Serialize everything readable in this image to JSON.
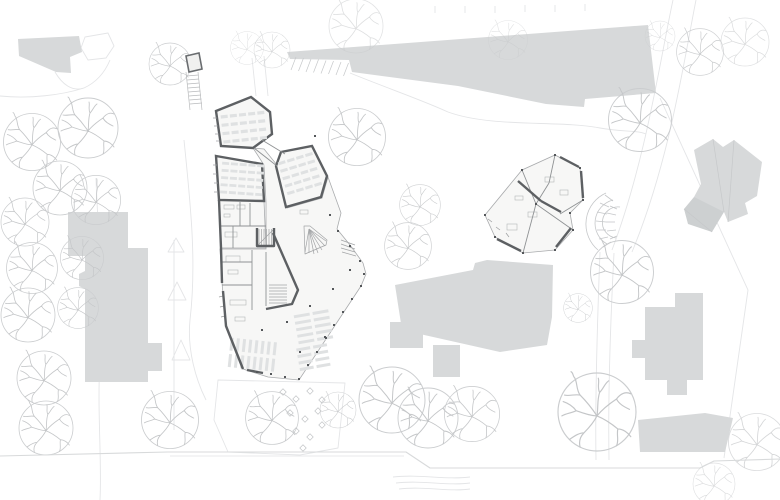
{
  "meta": {
    "kind": "architectural-site-plan",
    "width": 780,
    "height": 500,
    "background": "#ffffff"
  },
  "palette": {
    "context_fill": "#d7d9da",
    "context_fill_dark": "#cdd0d1",
    "wall_dark": "#5d6063",
    "footprint_fill": "#f7f7f6",
    "footprint_stroke": "#a9abad",
    "interior_line": "#8f9294",
    "stair_line": "#a2a4a6",
    "tick_line": "#9b9d9f",
    "furniture_fill": "#dfe1e2",
    "fixture_stroke": "#b4b6b8",
    "dot_fill": "#54575a",
    "tree_circle": "#cbcdcf",
    "tree_branch": "#c4c6c8",
    "faint_line": "#e4e5e7",
    "detail_line": "#c6c8ca",
    "boundary_line": "#d8dadb",
    "amphi_line": "#c5c7c9",
    "diamond_stroke": "#c3c5c7",
    "shelter_stroke": "#6a6d70",
    "ladder_line": "#b9bbbd"
  },
  "tree_symbol": {
    "circle_r": 30,
    "branches": "M0,3 C-4,-3 -8,-8 -13,-13 M-13,-13 C-16,-17 -15,-22 -17,-26 M-13,-13 C-17,-14 -21,-12 -25,-13 M-17,-26 C-19,-28 -18,-30 -20,-31 M0,3 C4,-2 9,-6 15,-10 M15,-10 C18,-14 22,-16 26,-14 M15,-10 C17,-6 21,-4 25,-2 M0,3 C5,5 10,8 16,13 M16,13 C20,13 24,16 26,19 M16,13 C15,18 17,22 15,26 M0,3 C-2,7 -5,11 -10,16 M-10,16 C-13,19 -14,23 -13,27 M-10,16 C-14,16 -18,19 -21,21 M0,3 C-5,3 -10,1 -16,-1 M-16,-1 C-20,1 -24,1 -27,3 M-16,-1 C-19,-5 -23,-7 -26,-8 M0,3 C1,-3 0,-9 2,-15 M2,-15 C0,-19 2,-23 1,-26 M2,-15 C5,-18 6,-22 9,-24"
  },
  "layers": [
    {
      "name": "faint-site-lines",
      "type": "paths",
      "stroke": "#e4e5e7",
      "width": 0.9,
      "items": [
        "M0,96 C30,99 62,95 84,88 C97,82 105,72 110,60",
        "M55,72 C62,84 72,92 84,88",
        "M85,37 L108,33 L114,46 L106,58 L88,60 L81,48 Z",
        "M96,178 C98,240 105,300 100,360 C97,410 102,460 100,500",
        "M184,140 C190,200 197,260 190,320 C187,350 196,380 206,400",
        "M252,58 L256,96",
        "M264,56 L268,96",
        "M350,73 C392,90 422,100 448,112",
        "M448,112 C492,128 560,120 600,128 C622,132 636,130 646,134",
        "M673,0 C660,60 646,160 612,250",
        "M696,0 C684,60 670,160 632,252",
        "M600,252 C597,330 595,400 596,460",
        "M614,253 C610,330 608,400 609,460",
        "M660,98 L748,290 L724,458",
        "M174,240 L174,430",
        "M168,252 L184,252 L176,238 Z",
        "M168,300 L186,300 L177,282 Z",
        "M172,360 L190,360 L181,340 Z",
        "M435,6 L435,13",
        "M465,6 L465,13",
        "M495,6 L495,13",
        "M525,5 L525,12",
        "M555,5 L555,12",
        "M585,4 L585,11",
        "M218,380 L345,383 L338,448 L300,455 L228,452 L214,420 Z",
        "M393,477 C420,474 446,480 470,477",
        "M396,483 C422,480 448,486 470,483",
        "M399,489 C424,486 450,492 470,489"
      ]
    },
    {
      "name": "context-buildings",
      "type": "polygons",
      "fill": "#d7d9da",
      "items": [
        {
          "name": "building-northwest",
          "points": "18,39 79,36 82,52 70,57 71,73 56,72 19,56"
        },
        {
          "name": "building-north-band",
          "points": "287,52 648,25 656,93 585,99 584,107 546,104 458,86 352,72 349,60 290,59"
        },
        {
          "name": "building-northeast-house",
          "points": "694,150 713,139 723,147 734,140 762,162 757,196 745,203 748,214 728,222 724,212 701,214 694,197 701,184"
        },
        {
          "name": "building-northeast-house-wing",
          "points": "694,197 724,212 712,232 688,224 684,209",
          "fill": "#cdd0d1"
        },
        {
          "name": "building-west-upper",
          "points": "68,212 128,212 128,256 68,256"
        },
        {
          "name": "building-west-main",
          "points": "85,248 148,248 148,343 162,343 162,371 148,371 148,382 85,382"
        },
        {
          "name": "building-west-bump",
          "points": "85,271 79,274 79,286 85,289"
        },
        {
          "name": "building-center-south",
          "points": "395,285 473,270 475,263 487,260 553,265 552,317 547,345 500,352 402,330"
        },
        {
          "name": "building-center-south-left",
          "points": "390,322 423,322 423,348 390,348"
        },
        {
          "name": "building-center-south-stem",
          "points": "433,345 460,345 460,377 433,377"
        },
        {
          "name": "building-southeast-cross",
          "points": "645,307 675,307 675,293 703,293 703,380 687,380 687,395 667,395 667,380 645,380 645,358 632,358 632,340 645,340"
        },
        {
          "name": "building-southeast-lower",
          "points": "638,420 705,413 733,418 725,452 640,452"
        }
      ]
    },
    {
      "name": "context-details",
      "type": "paths",
      "stroke": "#c6c8ca",
      "width": 0.7,
      "items": [
        "M296,57 L291,70",
        "M303.5,58 L298.5,71",
        "M311,59 L306,72",
        "M318.5,59.5 L313.5,72.5",
        "M326,60.5 L321,73.5",
        "M333.5,61 L328.5,74",
        "M341,62 L336,75",
        "M348.5,63 L343.5,76",
        "M713,139 L724,212",
        "M734,140 L728,222",
        "M684,209 L712,232"
      ]
    },
    {
      "name": "trees",
      "type": "trees",
      "items": [
        [
          32,
          142,
          0.95,
          1
        ],
        [
          88,
          128,
          1.0,
          1
        ],
        [
          60,
          188,
          0.9,
          1
        ],
        [
          25,
          222,
          0.8,
          1
        ],
        [
          96,
          200,
          0.82,
          1
        ],
        [
          32,
          268,
          0.85,
          1
        ],
        [
          82,
          258,
          0.72,
          1
        ],
        [
          28,
          315,
          0.9,
          1
        ],
        [
          78,
          308,
          0.68,
          1
        ],
        [
          44,
          378,
          0.9,
          1
        ],
        [
          46,
          428,
          0.9,
          1
        ],
        [
          170,
          420,
          0.95,
          1
        ],
        [
          170,
          64,
          0.7,
          1
        ],
        [
          247,
          48,
          0.55,
          0.6
        ],
        [
          272,
          50,
          0.6,
          0.7
        ],
        [
          356,
          26,
          0.9,
          0.55
        ],
        [
          508,
          40,
          0.65,
          0.5
        ],
        [
          745,
          42,
          0.8,
          0.6
        ],
        [
          357,
          137,
          0.95,
          1
        ],
        [
          420,
          205,
          0.68,
          0.9
        ],
        [
          408,
          246,
          0.78,
          0.9
        ],
        [
          272,
          418,
          0.88,
          1
        ],
        [
          338,
          410,
          0.6,
          0.9
        ],
        [
          392,
          400,
          1.1,
          1
        ],
        [
          428,
          418,
          1.0,
          1
        ],
        [
          472,
          414,
          0.92,
          0.95
        ],
        [
          640,
          120,
          1.05,
          1
        ],
        [
          700,
          52,
          0.78,
          0.9
        ],
        [
          660,
          36,
          0.5,
          0.7
        ],
        [
          622,
          272,
          1.05,
          1
        ],
        [
          578,
          308,
          0.48,
          1
        ],
        [
          597,
          412,
          1.3,
          1
        ],
        [
          757,
          442,
          0.95,
          0.7
        ],
        [
          714,
          484,
          0.7,
          0.6
        ]
      ]
    },
    {
      "name": "amphitheater-stair",
      "type": "paths",
      "stroke": "#c5c7c9",
      "width": 0.8,
      "items": [
        "M606,193 A34,34 0 0 0 598,250",
        "M613,200 A24,24 0 0 0 607,244",
        "M620,207 A14,14 0 0 0 616,238",
        "M605,195 L613,201",
        "M600,203 L609,207",
        "M597,212 L607,214",
        "M596,221 L606,222",
        "M597,230 L606,230",
        "M599,239 L608,237",
        "M603,247 L611,242",
        "M610,206 L617,209",
        "M607,213 L616,215",
        "M606,222 L615,222",
        "M607,231 L616,230",
        "M610,239 L617,236"
      ]
    },
    {
      "name": "terrace-tables",
      "type": "diamonds",
      "stroke": "#c3c5c7",
      "size": 3.2,
      "items": [
        [
          283,
          392
        ],
        [
          296,
          399
        ],
        [
          310,
          391
        ],
        [
          322,
          400
        ],
        [
          290,
          413
        ],
        [
          305,
          419
        ],
        [
          318,
          411
        ],
        [
          296,
          431
        ],
        [
          310,
          437
        ],
        [
          322,
          425
        ],
        [
          303,
          448
        ]
      ]
    },
    {
      "name": "building-footprints",
      "type": "polygons",
      "fill": "#f7f7f6",
      "stroke": "#a9abad",
      "width": 0.8,
      "items": [
        {
          "name": "main-hall-footprint",
          "points": "253,148 264,149 277,165 287,208 322,198 328,177 341,213 337,229 350,245 363,263 366,274 361,286 299,380 268,377 243,369 226,326 222,283 220,249 266,249 266,202 264,165"
        },
        {
          "name": "main-service-block",
          "points": "219,200 264,201 266,248 221,248"
        },
        {
          "name": "wing-classroom-nw",
          "points": "216,111 251,97 270,112 272,134 253,148 221,146",
          "stroke": "#5d6063",
          "width": 2.4
        },
        {
          "name": "wing-classroom-w",
          "points": "216,156 262,164 264,201 219,200",
          "stroke": "#5d6063",
          "width": 2.4
        },
        {
          "name": "wing-classroom-ne",
          "points": "276,166 281,152 312,146 327,176 321,197 286,207",
          "stroke": "#5d6063",
          "width": 2.4
        },
        {
          "name": "annex-footprint",
          "points": "485,215 522,170 555,155 580,168 583,200 570,213 573,230 555,250 523,253 495,237"
        }
      ]
    },
    {
      "name": "furniture-tables",
      "type": "tables",
      "fill": "#dfe1e2",
      "items": [
        {
          "x": 222,
          "y": 113,
          "cols": 5,
          "rows": 4,
          "cw": 7,
          "ch": 3.2,
          "gx": 2.2,
          "gy": 5.2,
          "rot": -6,
          "ox": 244,
          "oy": 128
        },
        {
          "x": 221,
          "y": 163,
          "cols": 5,
          "rows": 5,
          "cw": 7,
          "ch": 2.8,
          "gx": 1.8,
          "gy": 4.4,
          "rot": 4,
          "ox": 240,
          "oy": 180
        },
        {
          "x": 283,
          "y": 156,
          "cols": 4,
          "rows": 5,
          "cw": 7.5,
          "ch": 3,
          "gx": 2,
          "gy": 4.8,
          "rot": -17,
          "ox": 302,
          "oy": 177
        },
        {
          "x": 229,
          "y": 340,
          "cols": 8,
          "rows": 2,
          "cw": 3,
          "ch": 13,
          "gx": 3.2,
          "gy": 3.5,
          "rot": 6,
          "ox": 253,
          "oy": 356
        },
        {
          "x": 296,
          "y": 312,
          "cols": 2,
          "rows": 5,
          "cw": 16,
          "ch": 3,
          "gx": 3,
          "gy": 3.6,
          "rot": -10,
          "ox": 314,
          "oy": 327
        },
        {
          "x": 298,
          "y": 346,
          "cols": 2,
          "rows": 4,
          "cw": 14,
          "ch": 3,
          "gx": 3,
          "gy": 3.6,
          "rot": -10,
          "ox": 312,
          "oy": 358
        }
      ]
    },
    {
      "name": "fixtures",
      "type": "rects",
      "stroke": "#b4b6b8",
      "width": 0.6,
      "items": [
        [
          224,
          205,
          10,
          4
        ],
        [
          237,
          205,
          8,
          4
        ],
        [
          224,
          214,
          6,
          3
        ],
        [
          225,
          232,
          12,
          5
        ],
        [
          226,
          256,
          14,
          6
        ],
        [
          228,
          270,
          10,
          4
        ],
        [
          230,
          300,
          16,
          5
        ],
        [
          235,
          317,
          10,
          4
        ],
        [
          300,
          210,
          8,
          4
        ],
        [
          528,
          212,
          9,
          5
        ],
        [
          507,
          224,
          10,
          6
        ],
        [
          545,
          177,
          9,
          5
        ],
        [
          560,
          190,
          8,
          5
        ],
        [
          515,
          196,
          8,
          4
        ]
      ]
    },
    {
      "name": "interior-walls",
      "type": "paths",
      "stroke": "#8f9294",
      "width": 0.9,
      "items": [
        "M240,201 L240,226",
        "M221,226 L266,226",
        "M233,226 L233,248",
        "M250,203 L250,226",
        "M222,262 L252,262",
        "M252,250 L252,310",
        "M222,285 L252,285",
        "M254,148 L277,166",
        "M262,140 L285,154",
        "M266,252 L266,306",
        "M522,170 L536,204",
        "M536,204 L523,253",
        "M536,204 L573,230",
        "M555,155 L549,183",
        "M549,183 L536,204",
        "M583,200 L560,214"
      ]
    },
    {
      "name": "stairs",
      "type": "paths",
      "stroke": "#a2a4a6",
      "width": 0.7,
      "items": [
        "M259,229 L259,245",
        "M261.5,229 L261.5,245",
        "M264,229 L264,245",
        "M266.5,229 L266.5,245",
        "M269,229 L269,245",
        "M271.5,229 L271.5,245",
        "M258,245 L273,230",
        "M304,226 L310,226 L327,240 L326,245 L305,254 Z",
        "M309,229 L305,252",
        "M309,229 L309,253",
        "M309,229 L314,254",
        "M309,229 L318,253",
        "M309,229 L322,250",
        "M309,229 L325,246",
        "M309,229 L326,241",
        "M269,285 L287,285",
        "M269,288 L287,288",
        "M269,291 L287,291",
        "M269,294 L287,294",
        "M269,297 L287,297",
        "M269,300 L287,300",
        "M269,303 L287,303",
        "M341,240 L355,245",
        "M341,244 L355,249",
        "M341,248 L355,252",
        "M342,252 L356,256"
      ]
    },
    {
      "name": "window-ticks",
      "type": "paths",
      "stroke": "#9b9d9f",
      "width": 0.7,
      "items": [
        "M217,118 L213,118",
        "M218,126 L214,126",
        "M219,134 L215,134",
        "M220,141 L216,141",
        "M217,165 L213,165",
        "M217,174 L213,174",
        "M218,183 L214,183",
        "M218,192 L214,192",
        "M223,296 L219,297",
        "M224,306 L220,307",
        "M225,316 L221,317",
        "M492,222 L488,219",
        "M500,230 L496,227",
        "M509,237 L506,233"
      ]
    },
    {
      "name": "thick-walls",
      "type": "paths",
      "stroke": "#5d6063",
      "width": 2.4,
      "items": [
        "M219,200 L221,248",
        "M221,248 L222,283",
        "M223,291 L226,326 L243,369",
        "M247,370 L263,373",
        "M257,228 L257,246 L274,246 L274,228",
        "M273,233 L298,290 L292,304 L266,309",
        "M560,157 L579,167",
        "M581,171 L583,198",
        "M497,239 L521,251",
        "M518,181 L541,201",
        "M541,201 L561,212",
        "M571,228 L556,247"
      ]
    },
    {
      "name": "column-dots",
      "type": "dots",
      "fill": "#54575a",
      "size": 2,
      "items": [
        [
          361,
          286
        ],
        [
          352,
          299
        ],
        [
          343,
          312
        ],
        [
          334,
          325
        ],
        [
          326,
          338
        ],
        [
          317,
          352
        ],
        [
          308,
          365
        ],
        [
          299,
          379
        ],
        [
          285,
          377
        ],
        [
          271,
          374
        ],
        [
          257,
          372
        ],
        [
          330,
          215
        ],
        [
          338,
          231
        ],
        [
          350,
          246
        ],
        [
          360,
          261
        ],
        [
          364,
          274
        ],
        [
          262,
          330
        ],
        [
          287,
          322
        ],
        [
          310,
          306
        ],
        [
          333,
          289
        ],
        [
          350,
          270
        ],
        [
          300,
          352
        ],
        [
          325,
          337
        ],
        [
          315,
          136
        ],
        [
          485,
          215
        ],
        [
          522,
          170
        ],
        [
          555,
          155
        ],
        [
          580,
          168
        ],
        [
          583,
          200
        ],
        [
          570,
          213
        ],
        [
          573,
          230
        ],
        [
          555,
          250
        ],
        [
          523,
          253
        ],
        [
          495,
          237
        ],
        [
          536,
          204
        ]
      ]
    },
    {
      "name": "bike-shelter",
      "type": "polygons",
      "fill": "#f0f0ef",
      "stroke": "#6a6d70",
      "width": 1.6,
      "items": [
        {
          "name": "shelter-structure",
          "points": "186,56 199,53 202,69 189,72"
        }
      ]
    },
    {
      "name": "bike-racks",
      "type": "paths",
      "stroke": "#b9bbbd",
      "width": 0.7,
      "items": [
        "M186,72 L190,110",
        "M198,72 L202,110",
        "M186.5,76 L198.5,75",
        "M187,80 L199,79",
        "M187.5,84 L199.5,83",
        "M188,88 L200,87",
        "M188.5,92 L200.5,91",
        "M189,96 L201,95",
        "M189.5,100 L201.5,99",
        "M190,104 L202,103"
      ]
    },
    {
      "name": "site-boundary",
      "type": "paths",
      "stroke": "#d8dadb",
      "width": 1.1,
      "items": [
        "M0,456 L168,452 L406,452 L430,468 L700,468 L714,461 L780,459"
      ]
    },
    {
      "name": "site-boundary-inner",
      "type": "paths",
      "stroke": "#e2e3e5",
      "width": 0.7,
      "items": [
        "M170,456 L404,456"
      ]
    }
  ]
}
